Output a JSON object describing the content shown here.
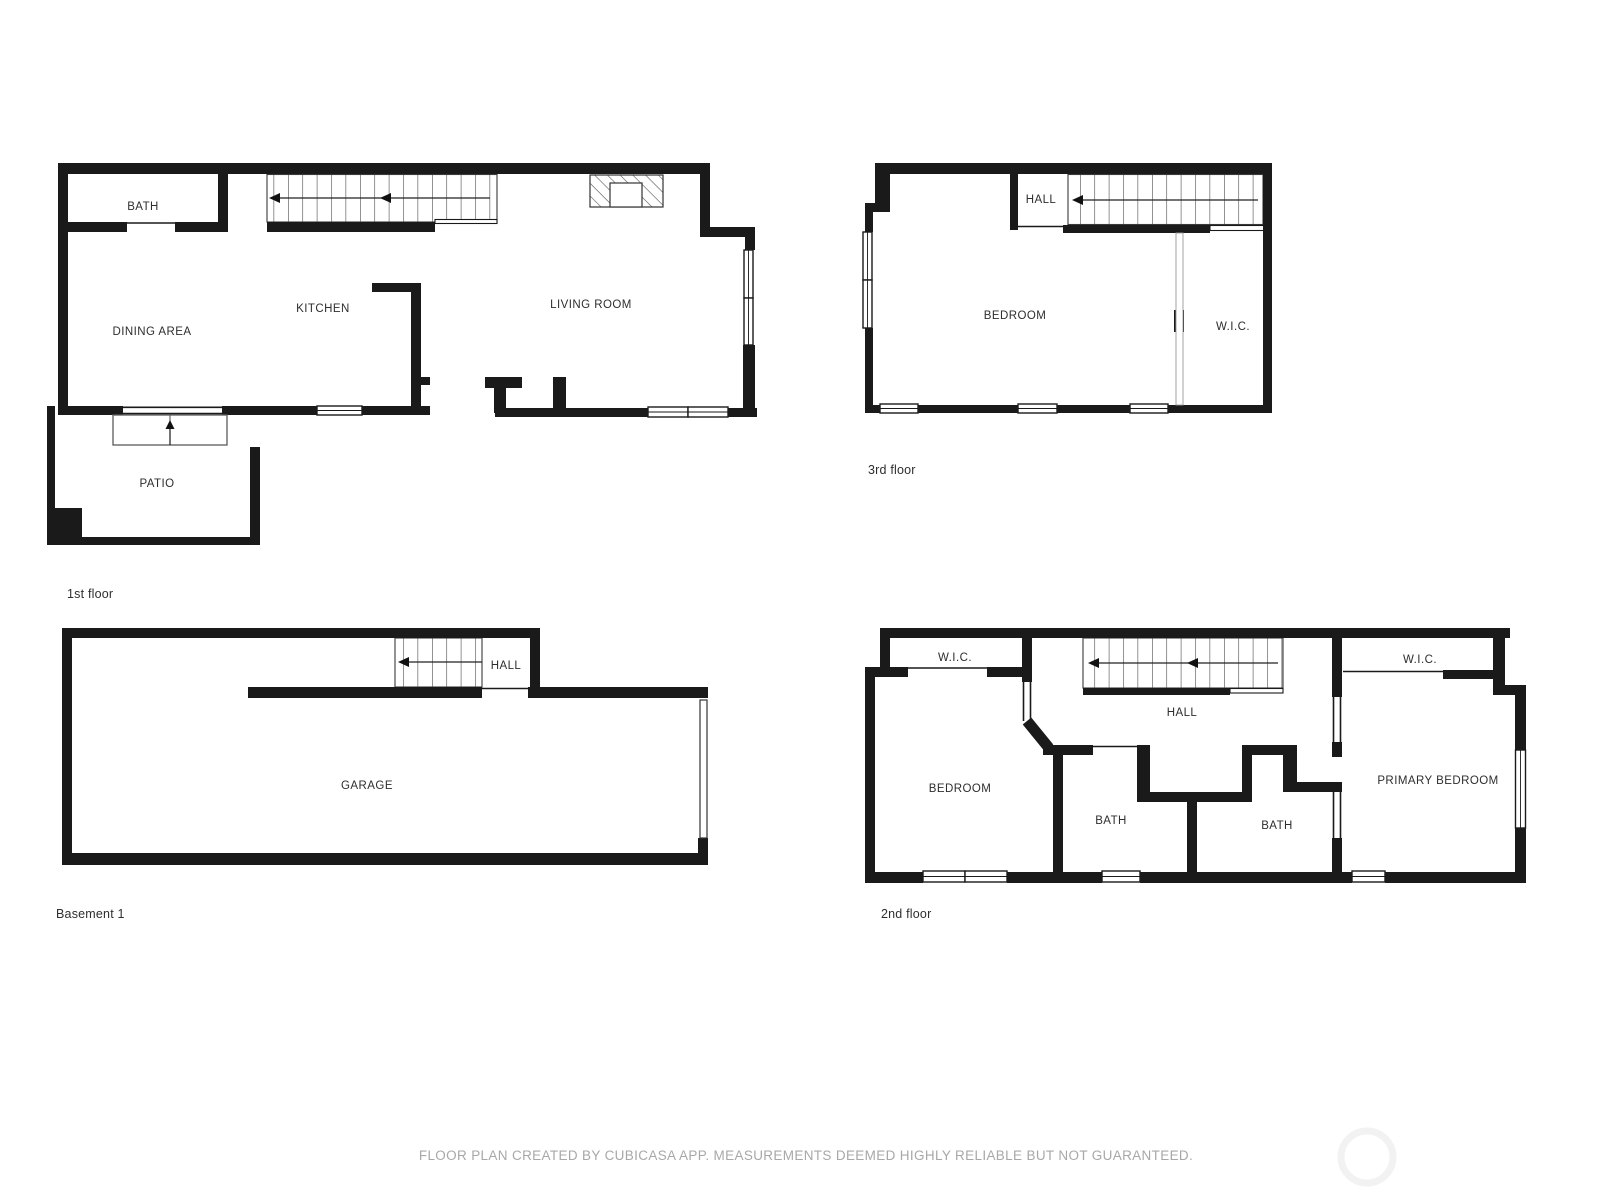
{
  "colors": {
    "wall": "#1a1a1a",
    "line": "#3a3a3a",
    "label": "#2e2e2e",
    "disclaimer": "#a8a8a8",
    "watermark": "#f2f2f2",
    "background": "#ffffff"
  },
  "floors": {
    "first": {
      "name": "1st floor",
      "rooms": {
        "bath": "BATH",
        "dining": "DINING AREA",
        "kitchen": "KITCHEN",
        "living": "LIVING ROOM",
        "patio": "PATIO"
      }
    },
    "third": {
      "name": "3rd floor",
      "rooms": {
        "hall": "HALL",
        "bedroom": "BEDROOM",
        "wic": "W.I.C."
      }
    },
    "basement": {
      "name": "Basement 1",
      "rooms": {
        "hall": "HALL",
        "garage": "GARAGE"
      }
    },
    "second": {
      "name": "2nd floor",
      "rooms": {
        "wic_left": "W.I.C.",
        "bedroom": "BEDROOM",
        "hall": "HALL",
        "bath_left": "BATH",
        "bath_right": "BATH",
        "wic_right": "W.I.C.",
        "primary": "PRIMARY BEDROOM"
      }
    }
  },
  "footer": {
    "disclaimer": "FLOOR PLAN CREATED BY CUBICASA APP. MEASUREMENTS DEEMED HIGHLY RELIABLE BUT NOT GUARANTEED."
  }
}
